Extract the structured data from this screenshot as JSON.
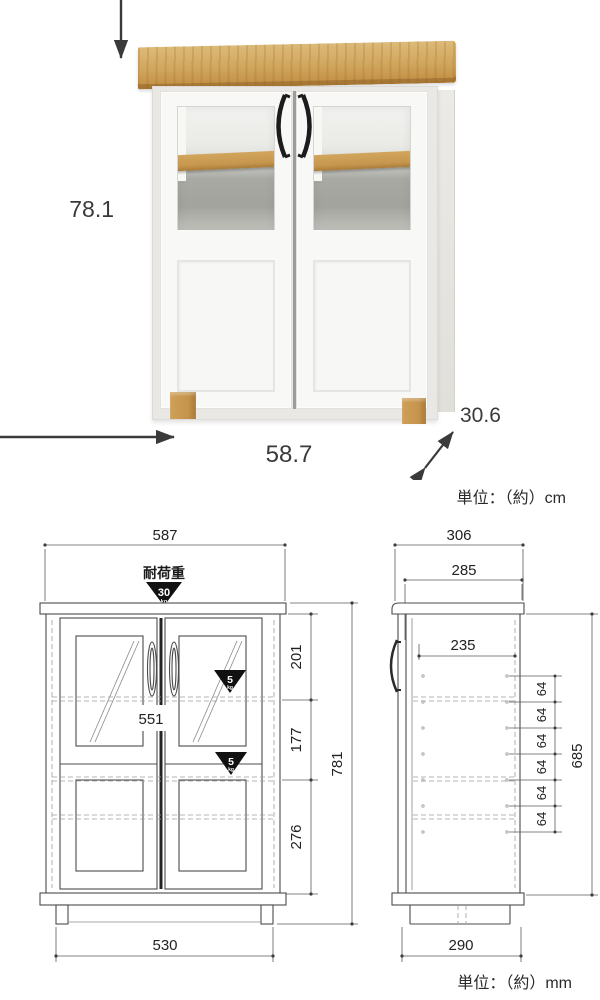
{
  "photo": {
    "height": "78.1",
    "width": "58.7",
    "depth": "30.6",
    "unit": "単位：（約）cm"
  },
  "drawing": {
    "unit": "単位：（約）mm",
    "front": {
      "load_caption": "耐荷重",
      "top_load": "30",
      "top_load_unit": "kg",
      "shelf_load": "5",
      "shelf_load_unit": "kg",
      "width_top": "587",
      "inner_width": "551",
      "section_top": "201",
      "section_mid": "177",
      "section_bottom": "276",
      "height_total": "781",
      "base_width": "530"
    },
    "side": {
      "depth_top": "306",
      "depth_inner_top": "285",
      "depth_inner": "235",
      "pitch": [
        "64",
        "64",
        "64",
        "64",
        "64",
        "64"
      ],
      "height_inner": "685",
      "base_depth": "290"
    }
  },
  "colors": {
    "wood": "#d0a55c",
    "body_white": "#f8f8f6",
    "handle_black": "#1c1c1c",
    "drawing_line": "#4c4c4c",
    "load_triangle": "#111111",
    "dimension_text": "#3a3a3a"
  }
}
